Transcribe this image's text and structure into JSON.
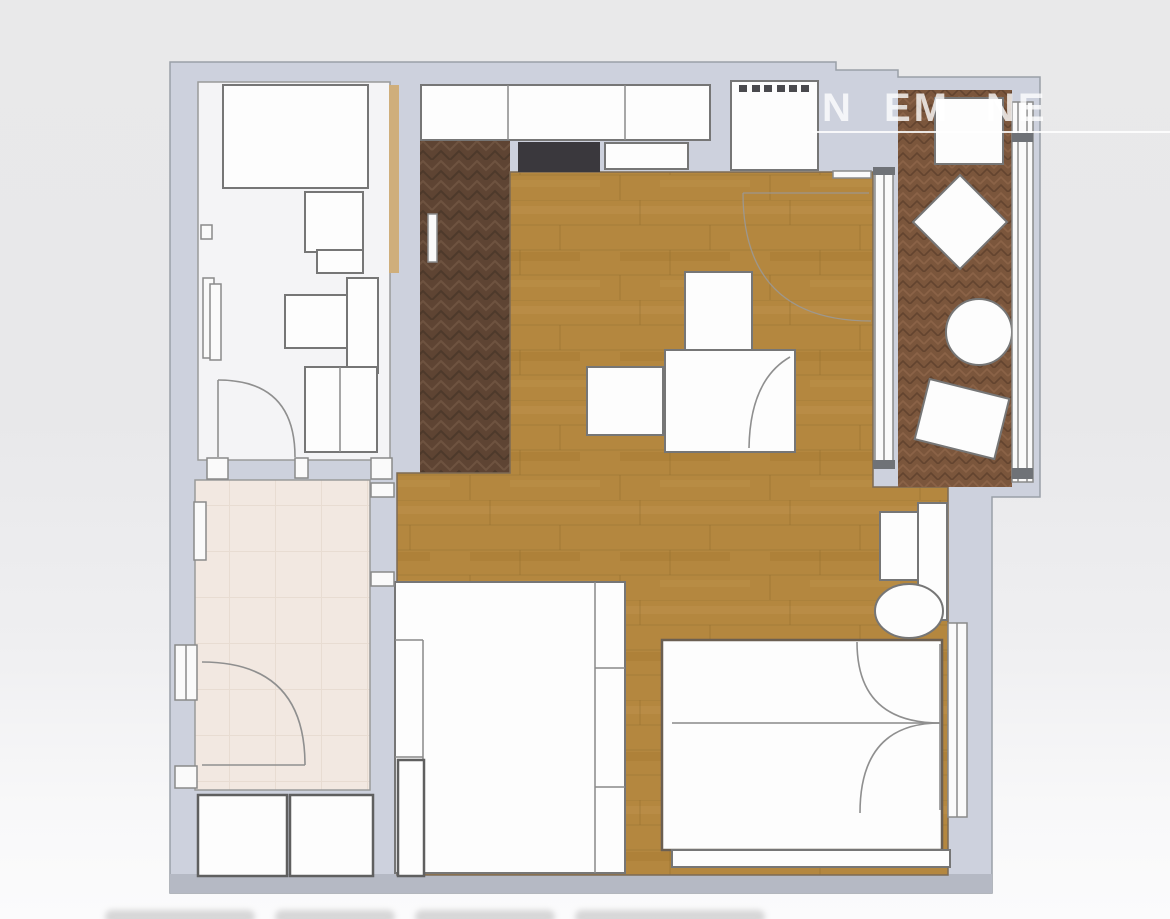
{
  "watermark": {
    "fragments": [
      "N",
      "EM",
      "NE"
    ]
  },
  "colors": {
    "wall_fill": "#cdd1dd",
    "wall_outline": "#9aa0a8",
    "wall_bottom_band": "#b5b9c4",
    "bathroom_floor": "#f4f4f6",
    "pink_room_floor": "#f2e8e1",
    "entry_parquet": "#5e4433",
    "living_parquet": "#b4873f",
    "balcony_parquet": "#7b563c",
    "furniture_fill": "#fdfdfd",
    "furniture_outline": "#767676",
    "cooktop": "#3a383d",
    "sliding_door_wood": "#cfae7b",
    "watermark": "#ffffff"
  }
}
